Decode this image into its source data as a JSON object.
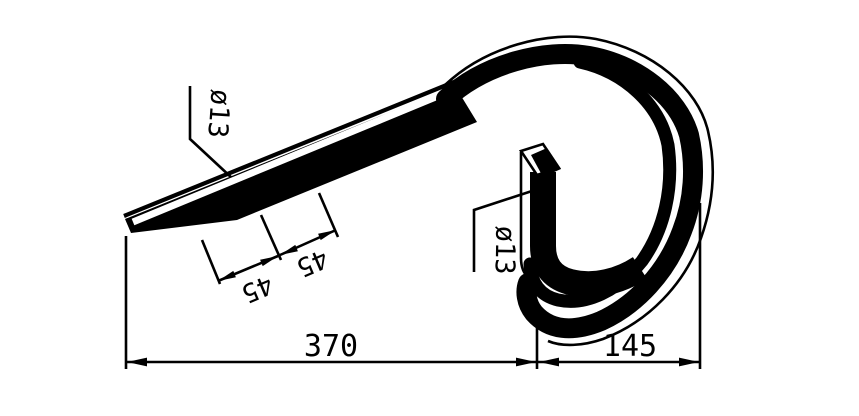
{
  "drawing": {
    "kind": "technical-drawing",
    "colors": {
      "ink": "#000000",
      "background": "#ffffff"
    },
    "dimensions": {
      "shank_bar_diameter": {
        "label": "ø13"
      },
      "leg_bar_diameter": {
        "label": "ø13"
      },
      "shank_spacing_first": {
        "label": "45"
      },
      "shank_spacing_second": {
        "label": "45"
      },
      "overall_length": {
        "label": "370"
      },
      "coil_width": {
        "label": "145"
      }
    }
  }
}
